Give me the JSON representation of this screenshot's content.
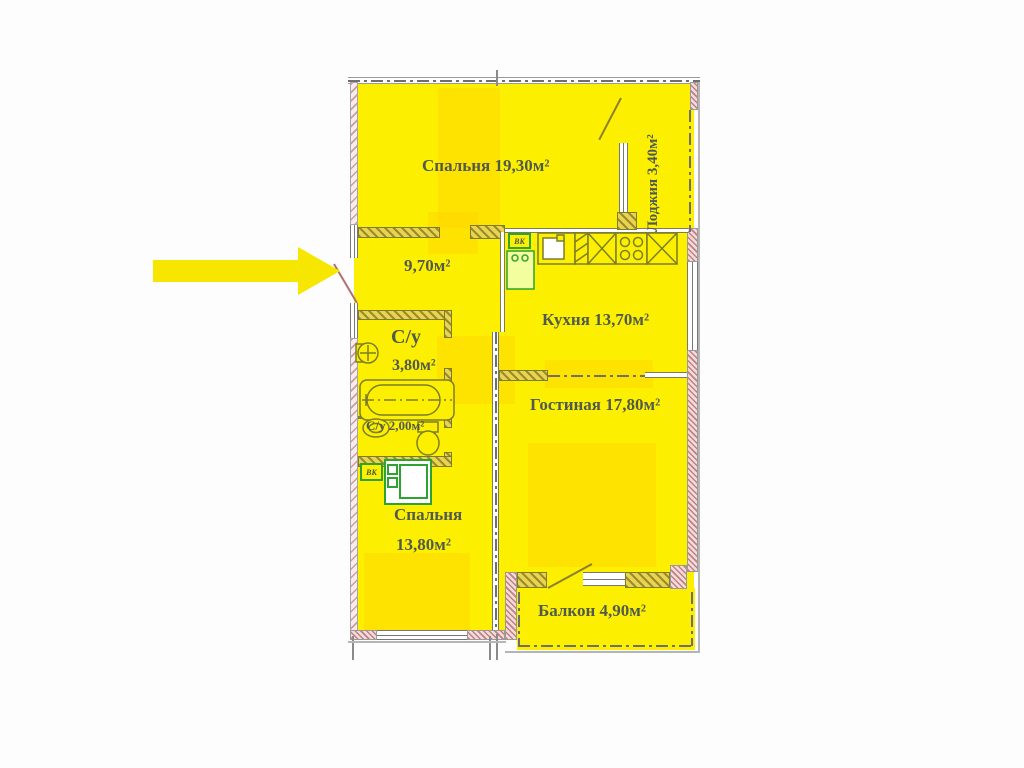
{
  "plan_title": "2-room apartment floor plan",
  "colors": {
    "room_fill": "#fcf000",
    "room_fill_shaded": "#ffd900",
    "exterior_wall_hatch": "#c27f7f",
    "interior_wall_hatch": "#9c8b2e",
    "fixture_green": "#2fa32f",
    "label_text": "#515a4e",
    "arrow_yellow": "#f7e600"
  },
  "rooms": [
    {
      "id": "bedroom-top",
      "label": "Спальня 19,30м²"
    },
    {
      "id": "loggia",
      "label": "Лоджия 3,40м²"
    },
    {
      "id": "hallway",
      "label": "9,70м²"
    },
    {
      "id": "kitchen",
      "label": "Кухня 13,70м²"
    },
    {
      "id": "bathroom",
      "name": "С/у",
      "area": "3,80м²"
    },
    {
      "id": "toilet",
      "label": "С/у 2,00м²"
    },
    {
      "id": "living-room",
      "label": "Гостиная 17,80м²"
    },
    {
      "id": "bedroom-bottom",
      "name": "Спальня",
      "area": "13,80м²"
    },
    {
      "id": "balcony",
      "label": "Балкон 4,90м²"
    }
  ],
  "vent_labels": {
    "kitchen": "ВК",
    "bathroom": "ВК"
  }
}
